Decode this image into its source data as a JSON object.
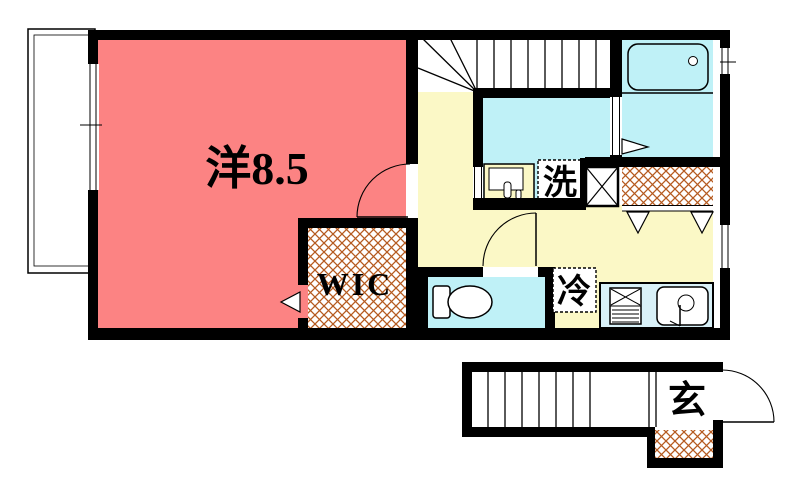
{
  "labels": {
    "bedroom": "洋8.5",
    "wic": "WIC",
    "laundry": "洗",
    "refrigerator": "冷",
    "entrance": "玄"
  },
  "colors": {
    "bedroom_fill": "#fc8383",
    "hall_fill": "#fbf8c6",
    "wet_area_fill": "#bff1f7",
    "kitchen_counter_fill": "#d9f1f8",
    "hatch_line": "#b55a1f",
    "wall": "#000000"
  }
}
